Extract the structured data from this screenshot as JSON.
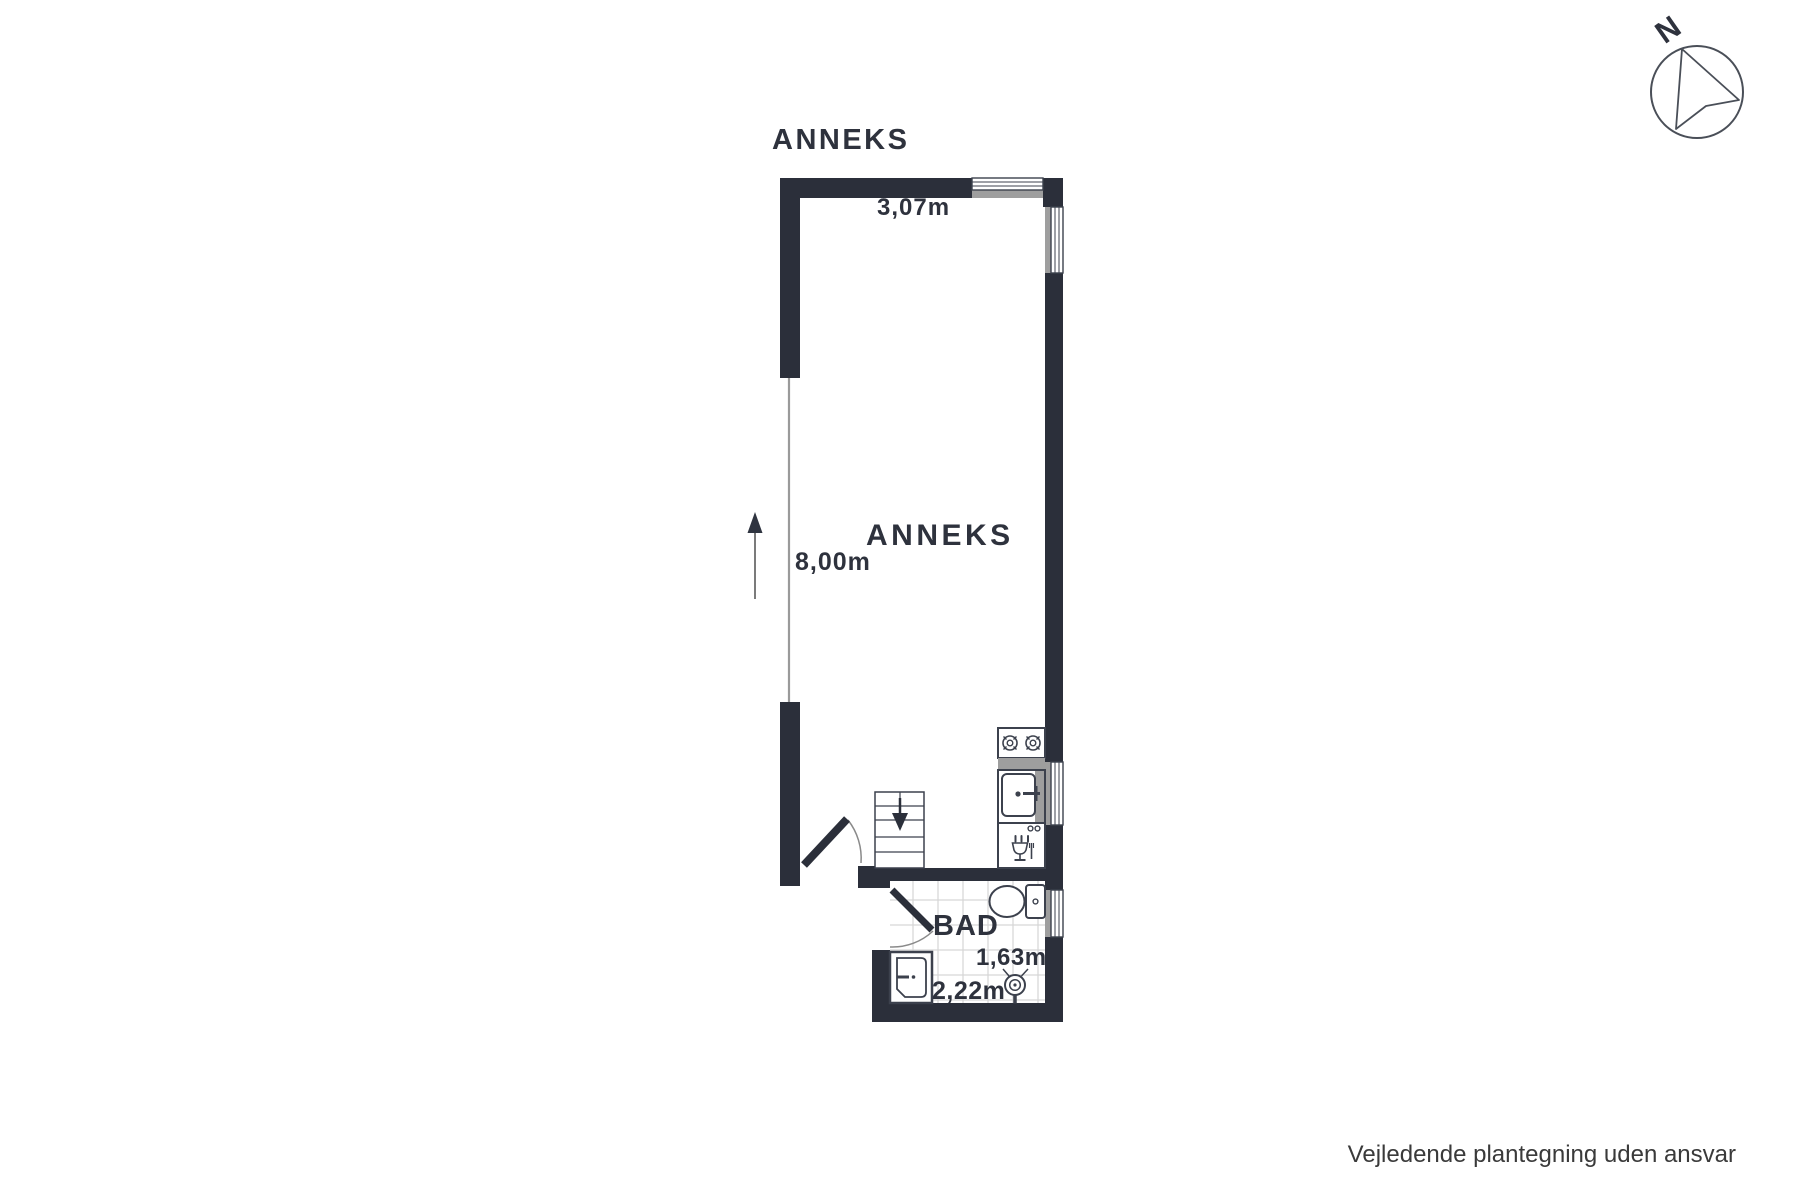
{
  "plan": {
    "title": "ANNEKS",
    "room_label": "ANNEKS",
    "bathroom_label": "BAD",
    "dimensions": {
      "top_width": "3,07m",
      "left_height": "8,00m",
      "bathroom_height": "1,63m",
      "bathroom_width": "2,22m"
    }
  },
  "compass": {
    "north_label": "N"
  },
  "footer": {
    "disclaimer": "Vejledende plantegning uden ansvar"
  },
  "icons": {
    "compass": "north-compass-icon",
    "entry_direction": "up-arrow-icon",
    "stairs": "stairs-down-arrow-icon",
    "kitchen": [
      "stove-burners-icon",
      "kitchen-sink-icon",
      "dishwasher-icon"
    ],
    "bathroom": [
      "toilet-icon",
      "washbasin-icon",
      "shower-head-icon"
    ]
  },
  "colors": {
    "wall": "#2b2f3a",
    "window_gray": "#9e9e9e",
    "fixture_line": "#3c414d",
    "arc_line": "#8a8a8a",
    "tile_line": "#d6d6d6",
    "label_text": "#2e323d",
    "disclaimer_text": "#3a3a3a",
    "background": "#ffffff"
  }
}
